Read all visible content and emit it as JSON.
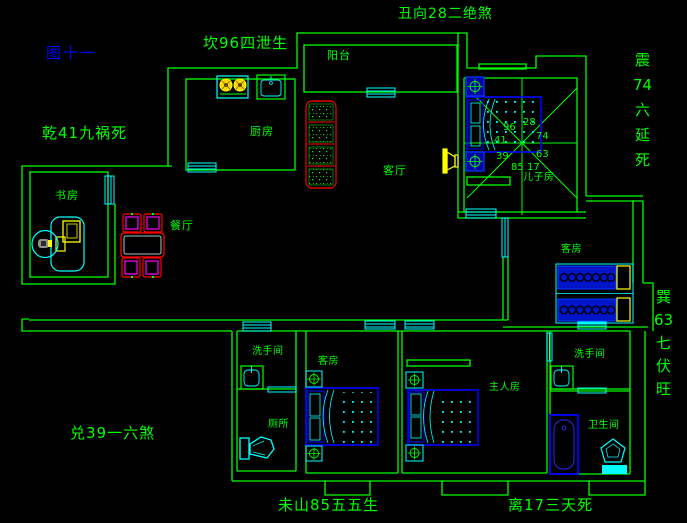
{
  "figure_label": "图十一",
  "annotations": {
    "top_center": "丑向28二绝煞",
    "top_left": "坎96四泄生",
    "left_upper": "乾41九祸死",
    "left_lower": "兑39一六煞",
    "bottom_left": "未山85五五生",
    "bottom_right": "离17三天死",
    "right_upper": {
      "text": "震74六延死",
      "segments": [
        "震",
        "74",
        "六",
        "延",
        "死"
      ]
    },
    "right_lower": {
      "text": "巽63七伏旺",
      "segments": [
        "巽",
        "63",
        "七",
        "伏",
        "旺"
      ]
    }
  },
  "rooms": {
    "balcony": "阳台",
    "kitchen": "厨房",
    "study": "书房",
    "dining": "餐厅",
    "living": "客厅",
    "son_room": "儿子房",
    "guest_room_mid": "客房",
    "washroom_1": "洗手间",
    "toilet": "厕所",
    "guest_room_bottom": "客房",
    "master_room": "主人房",
    "washroom_2": "洗手间",
    "bathroom": "卫生间"
  },
  "compass": {
    "nw": "96",
    "ne": "28",
    "w": "41",
    "e": "74",
    "sw": "39",
    "se": "63",
    "s_left": "85",
    "s_right": "17"
  },
  "colors": {
    "background": "#000000",
    "walls": "#00ff00",
    "fixtures": "#00ffff",
    "furniture_blue": "#0000ff",
    "sofa_red": "#ff0000",
    "chair_magenta": "#ff00ff",
    "appliance_yellow": "#ffff00",
    "text_green": "#00ff00",
    "figure_label_blue": "#0000ff"
  }
}
